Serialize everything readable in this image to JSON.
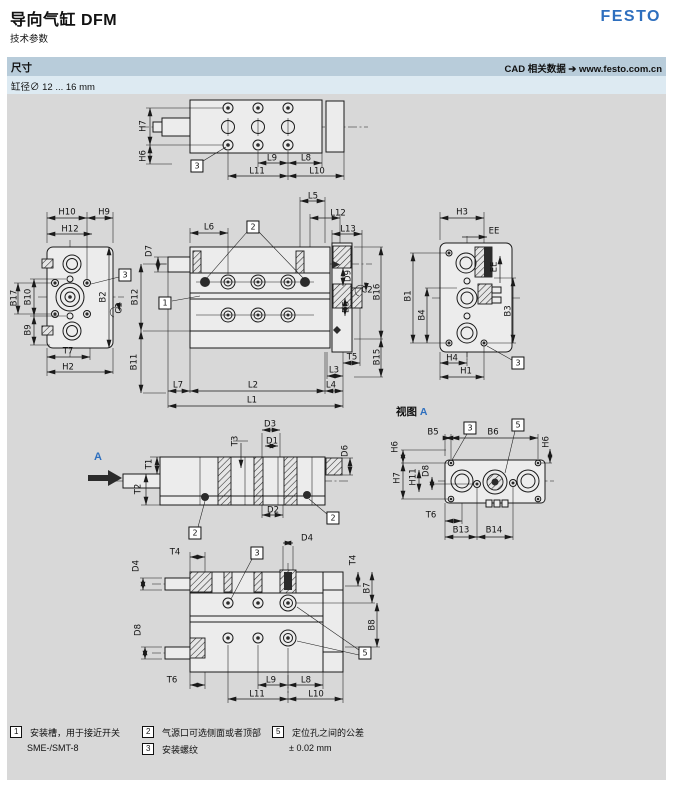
{
  "header": {
    "title": "导向气缸 DFM",
    "subtitle": "技术参数",
    "brand": "FESTO"
  },
  "section_bar": {
    "left": "尺寸",
    "right": "CAD 相关数据 ➔ www.festo.com.cn"
  },
  "bore_line": "缸径∅ 12 ... 16 mm",
  "view_a": {
    "prefix": "视图",
    "letter": "A"
  },
  "section_arrow": {
    "letter": "A"
  },
  "colors": {
    "brand_blue": "#2e6fbe",
    "section_bar_bg": "#b8ccda",
    "bore_row_bg": "#ddeaf2",
    "canvas_bg": "#d8d8d8",
    "line": "#1a1a1a"
  },
  "labels": [
    {
      "t": "H7",
      "x": 144,
      "y": 126,
      "r": 1
    },
    {
      "t": "H6",
      "x": 144,
      "y": 156,
      "r": 1
    },
    {
      "t": "3",
      "x": 197,
      "y": 166,
      "box": 1
    },
    {
      "t": "L9",
      "x": 272,
      "y": 159
    },
    {
      "t": "L8",
      "x": 306,
      "y": 159
    },
    {
      "t": "L11",
      "x": 257,
      "y": 172
    },
    {
      "t": "L10",
      "x": 317,
      "y": 172
    },
    {
      "t": "H10",
      "x": 67,
      "y": 213
    },
    {
      "t": "H9",
      "x": 104,
      "y": 213
    },
    {
      "t": "H12",
      "x": 70,
      "y": 230
    },
    {
      "t": "B17",
      "x": 15,
      "y": 298,
      "r": 1
    },
    {
      "t": "B10",
      "x": 29,
      "y": 297,
      "r": 1
    },
    {
      "t": "B9",
      "x": 29,
      "y": 330,
      "r": 1
    },
    {
      "t": "B2",
      "x": 104,
      "y": 297,
      "r": 1
    },
    {
      "t": "3",
      "x": 125,
      "y": 275,
      "box": 1
    },
    {
      "t": "C1",
      "x": 120,
      "y": 308,
      "r": 1
    },
    {
      "t": "T7",
      "x": 68,
      "y": 352
    },
    {
      "t": "H2",
      "x": 68,
      "y": 368
    },
    {
      "t": "L6",
      "x": 209,
      "y": 228
    },
    {
      "t": "2",
      "x": 253,
      "y": 227,
      "box": 1
    },
    {
      "t": "L5",
      "x": 313,
      "y": 197
    },
    {
      "t": "L12",
      "x": 338,
      "y": 214
    },
    {
      "t": "L13",
      "x": 348,
      "y": 230
    },
    {
      "t": "D7",
      "x": 150,
      "y": 251,
      "r": 1
    },
    {
      "t": "1",
      "x": 165,
      "y": 303,
      "box": 1
    },
    {
      "t": "B12",
      "x": 136,
      "y": 297,
      "r": 1
    },
    {
      "t": "B11",
      "x": 135,
      "y": 362,
      "r": 1
    },
    {
      "t": "D9",
      "x": 349,
      "y": 276,
      "r": 1
    },
    {
      "t": "C2",
      "x": 367,
      "y": 291
    },
    {
      "t": "B16",
      "x": 378,
      "y": 292,
      "r": 1
    },
    {
      "t": "D5",
      "x": 347,
      "y": 307,
      "r": 1
    },
    {
      "t": "B15",
      "x": 378,
      "y": 357,
      "r": 1
    },
    {
      "t": "T5",
      "x": 352,
      "y": 358
    },
    {
      "t": "L3",
      "x": 334,
      "y": 371
    },
    {
      "t": "L4",
      "x": 331,
      "y": 386
    },
    {
      "t": "L7",
      "x": 178,
      "y": 386
    },
    {
      "t": "L2",
      "x": 253,
      "y": 386
    },
    {
      "t": "L1",
      "x": 252,
      "y": 401
    },
    {
      "t": "H3",
      "x": 462,
      "y": 213
    },
    {
      "t": "EE",
      "x": 494,
      "y": 232
    },
    {
      "t": "EE",
      "x": 495,
      "y": 267,
      "r": 1
    },
    {
      "t": "B1",
      "x": 409,
      "y": 296,
      "r": 1
    },
    {
      "t": "B4",
      "x": 423,
      "y": 315,
      "r": 1
    },
    {
      "t": "B3",
      "x": 509,
      "y": 311,
      "r": 1
    },
    {
      "t": "H4",
      "x": 452,
      "y": 359
    },
    {
      "t": "H1",
      "x": 466,
      "y": 372
    },
    {
      "t": "3",
      "x": 518,
      "y": 363,
      "box": 1
    },
    {
      "t": "T1",
      "x": 150,
      "y": 464,
      "r": 1
    },
    {
      "t": "T2",
      "x": 139,
      "y": 489,
      "r": 1
    },
    {
      "t": "T3",
      "x": 236,
      "y": 441,
      "r": 1
    },
    {
      "t": "D3",
      "x": 270,
      "y": 425
    },
    {
      "t": "D1",
      "x": 272,
      "y": 442
    },
    {
      "t": "D6",
      "x": 346,
      "y": 451,
      "r": 1
    },
    {
      "t": "D2",
      "x": 273,
      "y": 511
    },
    {
      "t": "2",
      "x": 195,
      "y": 533,
      "box": 1
    },
    {
      "t": "2",
      "x": 333,
      "y": 518,
      "box": 1
    },
    {
      "t": "B5",
      "x": 433,
      "y": 433
    },
    {
      "t": "3",
      "x": 470,
      "y": 428,
      "box": 1
    },
    {
      "t": "B6",
      "x": 493,
      "y": 433
    },
    {
      "t": "5",
      "x": 518,
      "y": 425,
      "box": 1
    },
    {
      "t": "H6",
      "x": 396,
      "y": 447,
      "r": 1
    },
    {
      "t": "H6",
      "x": 547,
      "y": 442,
      "r": 1
    },
    {
      "t": "H7",
      "x": 398,
      "y": 478,
      "r": 1
    },
    {
      "t": "H11",
      "x": 414,
      "y": 477,
      "r": 1
    },
    {
      "t": "D8",
      "x": 427,
      "y": 471,
      "r": 1
    },
    {
      "t": "T6",
      "x": 431,
      "y": 516
    },
    {
      "t": "B13",
      "x": 461,
      "y": 531
    },
    {
      "t": "B14",
      "x": 494,
      "y": 531
    },
    {
      "t": "T4",
      "x": 175,
      "y": 553
    },
    {
      "t": "3",
      "x": 257,
      "y": 553,
      "box": 1
    },
    {
      "t": "D4",
      "x": 307,
      "y": 539
    },
    {
      "t": "D4",
      "x": 137,
      "y": 566,
      "r": 1
    },
    {
      "t": "D8",
      "x": 139,
      "y": 630,
      "r": 1
    },
    {
      "t": "T4",
      "x": 354,
      "y": 560,
      "r": 1
    },
    {
      "t": "B7",
      "x": 368,
      "y": 588,
      "r": 1
    },
    {
      "t": "B8",
      "x": 373,
      "y": 625,
      "r": 1
    },
    {
      "t": "5",
      "x": 365,
      "y": 653,
      "box": 1
    },
    {
      "t": "T6",
      "x": 172,
      "y": 681
    },
    {
      "t": "L9",
      "x": 271,
      "y": 681
    },
    {
      "t": "L8",
      "x": 306,
      "y": 681
    },
    {
      "t": "L11",
      "x": 257,
      "y": 695
    },
    {
      "t": "L10",
      "x": 316,
      "y": 695
    }
  ],
  "legend": [
    {
      "num": "1",
      "lines": [
        "安装槽，用于接近开关",
        "SME-/SMT-8"
      ]
    },
    {
      "num": "2",
      "lines": [
        "气源口可选侧面或者顶部"
      ]
    },
    {
      "num": "3",
      "lines": [
        "安装螺纹"
      ]
    },
    {
      "num": "5",
      "lines": [
        "定位孔之间的公差",
        "± 0.02 mm"
      ]
    }
  ]
}
